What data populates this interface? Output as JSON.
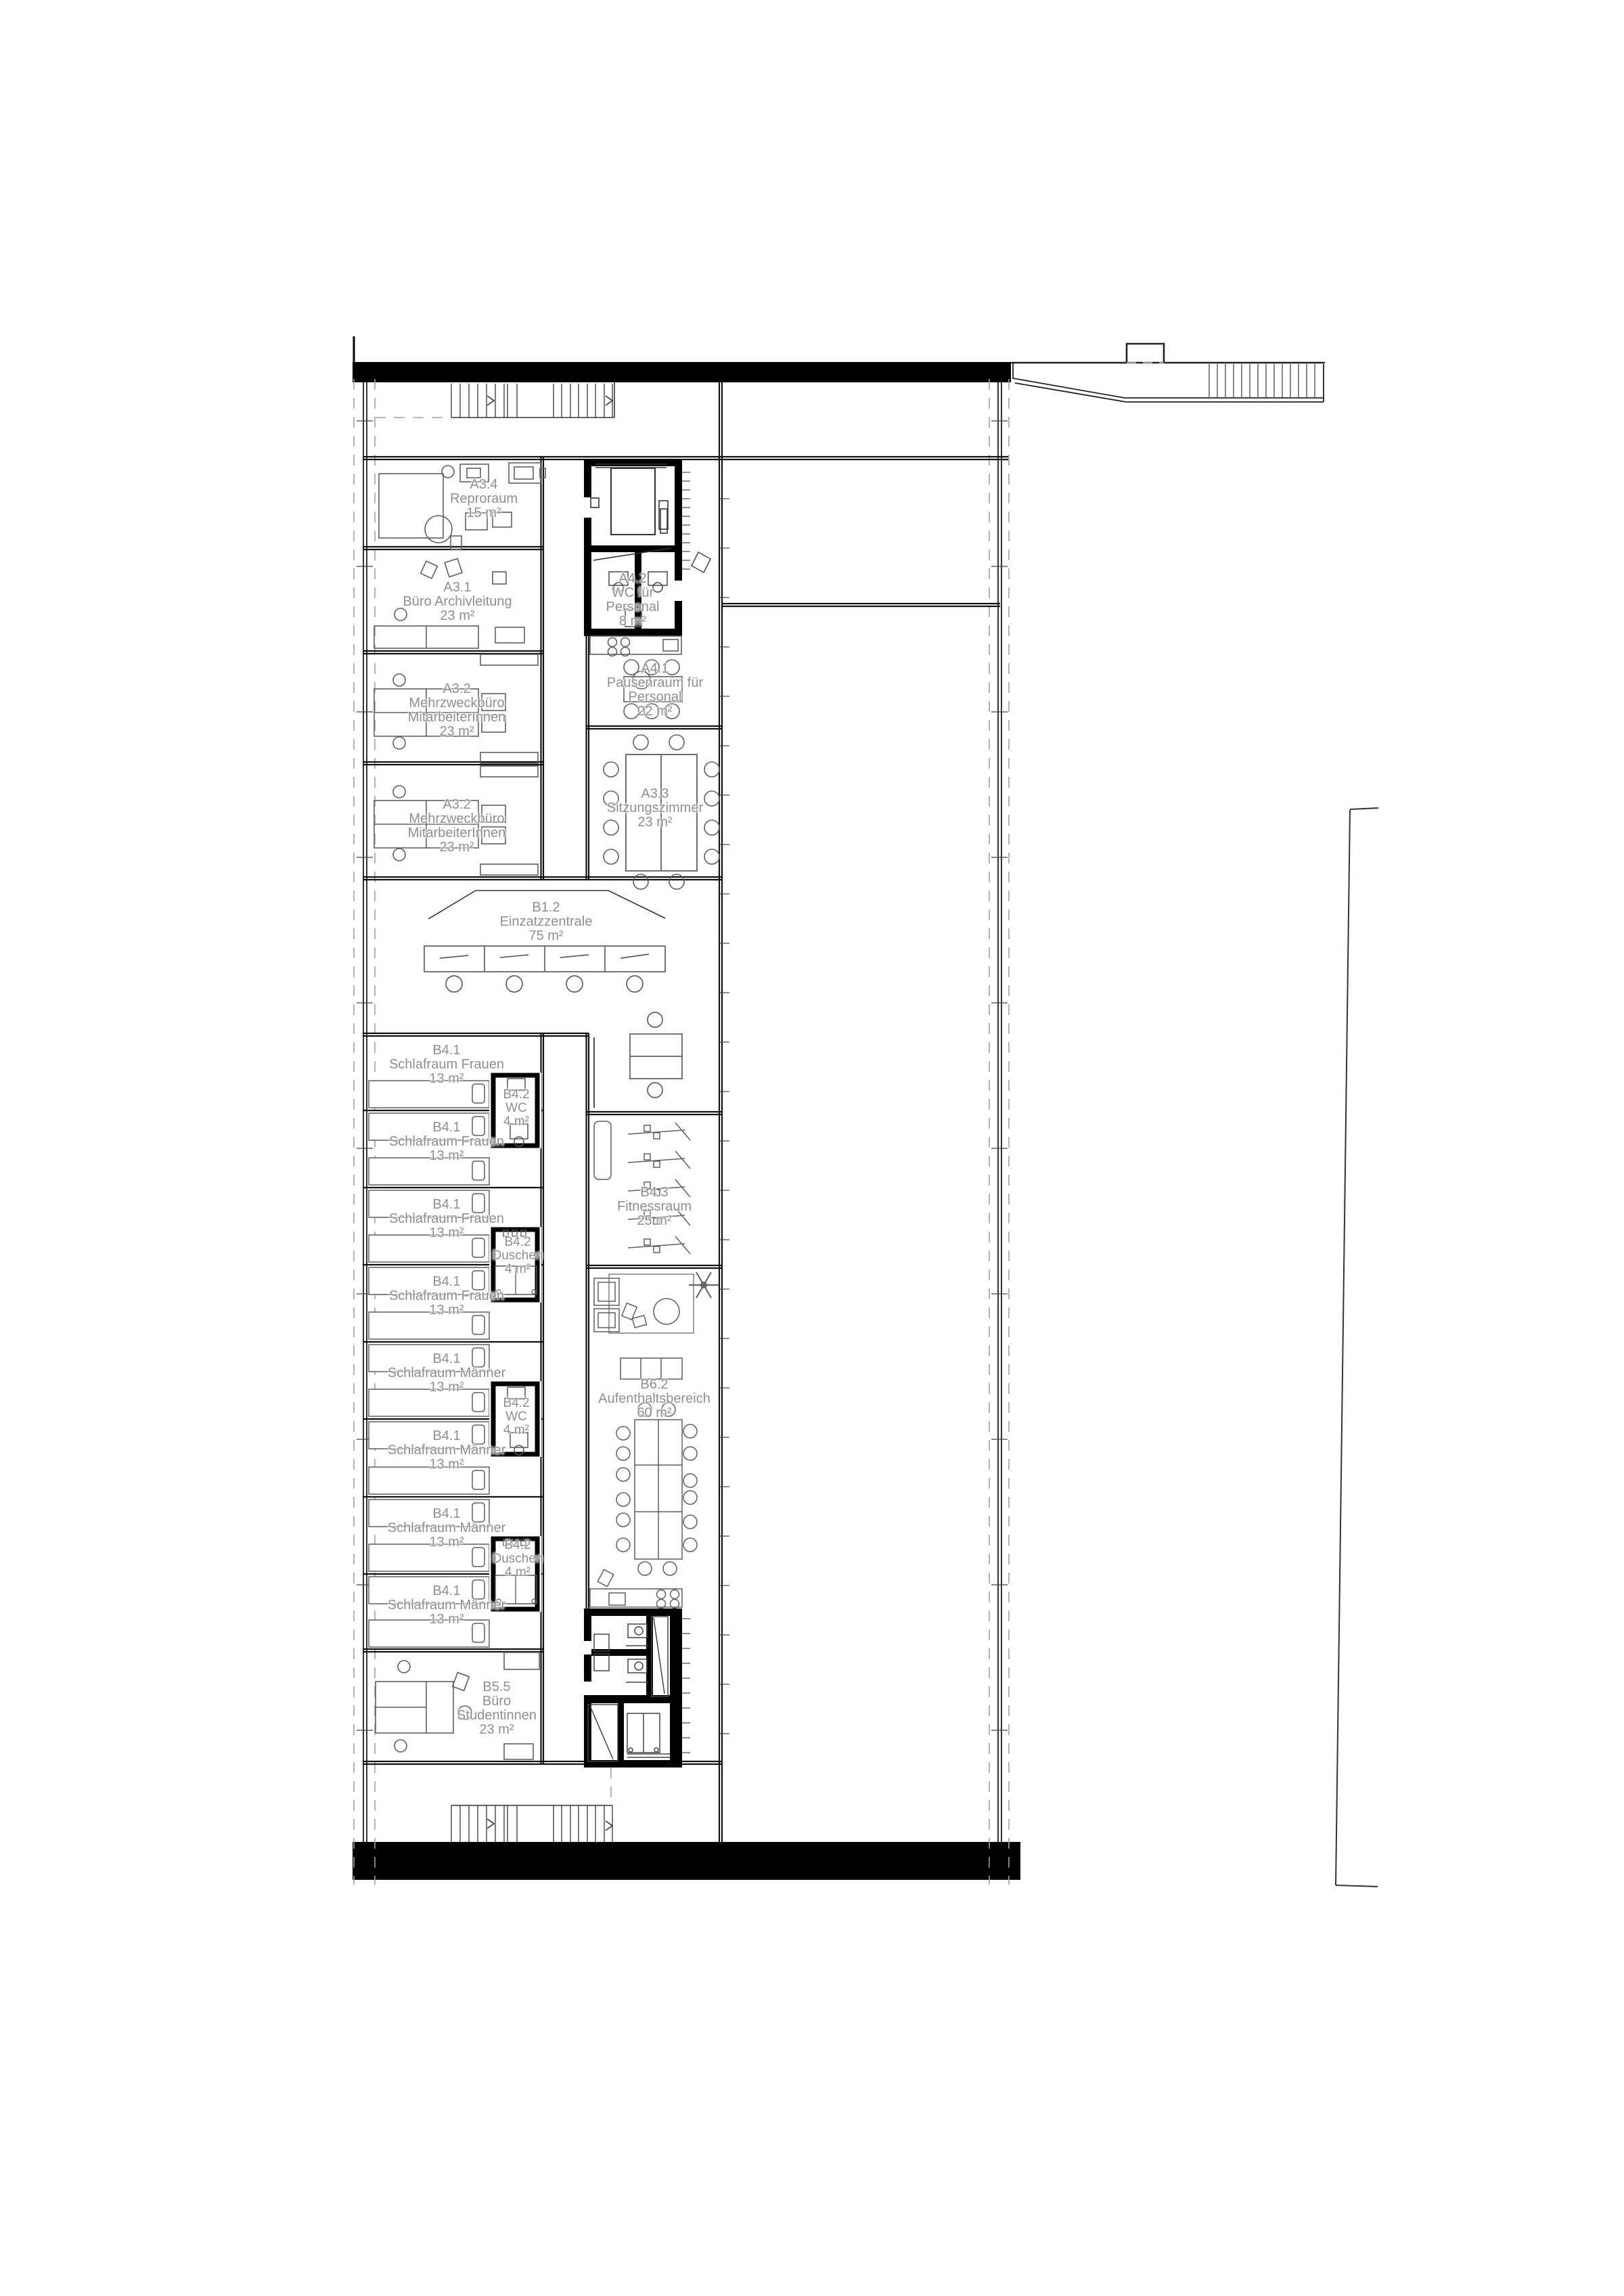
{
  "drawing": {
    "kind": "architectural floor plan",
    "language": "de",
    "colors": {
      "wall": "#000000",
      "line": "#1a1a1a",
      "furniture": "#5f5f5f",
      "label": "#8f8f8f",
      "dashed": "#a0a0a0"
    }
  },
  "rooms": [
    {
      "id": "A3.4",
      "name": "Reproraum",
      "area": "15 m²"
    },
    {
      "id": "A3.1",
      "name": "Büro Archivleitung",
      "area": "23 m²"
    },
    {
      "id": "A3.2",
      "name": "Mehrzweckbüro",
      "name2": "MitarbeiterInnen",
      "area": "23 m²"
    },
    {
      "id": "A3.2",
      "name": "Mehrzweckbüro",
      "name2": "MitarbeiterInnen",
      "area": "23 m²"
    },
    {
      "id": "A4.2",
      "name": "WC für",
      "name2": "Personal",
      "area": "8 m²"
    },
    {
      "id": "A4.1",
      "name": "Pausenraum für",
      "name2": "Personal",
      "area": "22 m²"
    },
    {
      "id": "A3.3",
      "name": "Sitzungszimmer",
      "area": "23 m²"
    },
    {
      "id": "B1.2",
      "name": "Einzatzzentrale",
      "area": "75 m²"
    },
    {
      "id": "B4.1",
      "name": "Schlafraum Frauen",
      "area": "13 m²"
    },
    {
      "id": "B4.1",
      "name": "Schlafraum Frauen",
      "area": "13 m²"
    },
    {
      "id": "B4.1",
      "name": "Schlafraum Frauen",
      "area": "13 m²"
    },
    {
      "id": "B4.1",
      "name": "Schlafraum Frauen",
      "area": "13 m²"
    },
    {
      "id": "B4.2",
      "name": "WC",
      "area": "4 m²"
    },
    {
      "id": "B4.2",
      "name": "Duschen",
      "area": "4 m²"
    },
    {
      "id": "B4.2",
      "name": "WC",
      "area": "4 m²"
    },
    {
      "id": "B4.2",
      "name": "Duschen",
      "area": "4 m²"
    },
    {
      "id": "B4.1",
      "name": "Schlafraum Männer",
      "area": "13 m²"
    },
    {
      "id": "B4.1",
      "name": "Schlafraum Männer",
      "area": "13 m²"
    },
    {
      "id": "B4.1",
      "name": "Schlafraum Männer",
      "area": "13 m²"
    },
    {
      "id": "B4.1",
      "name": "Schlafraum Männer",
      "area": "13 m²"
    },
    {
      "id": "B4.3",
      "name": "Fitnessraum",
      "area": "25 m²"
    },
    {
      "id": "B6.2",
      "name": "Aufenthaltsbereich",
      "area": "60 m²"
    },
    {
      "id": "B5.5",
      "name": "Büro",
      "name2": "Studentinnen",
      "area": "23 m²"
    }
  ]
}
